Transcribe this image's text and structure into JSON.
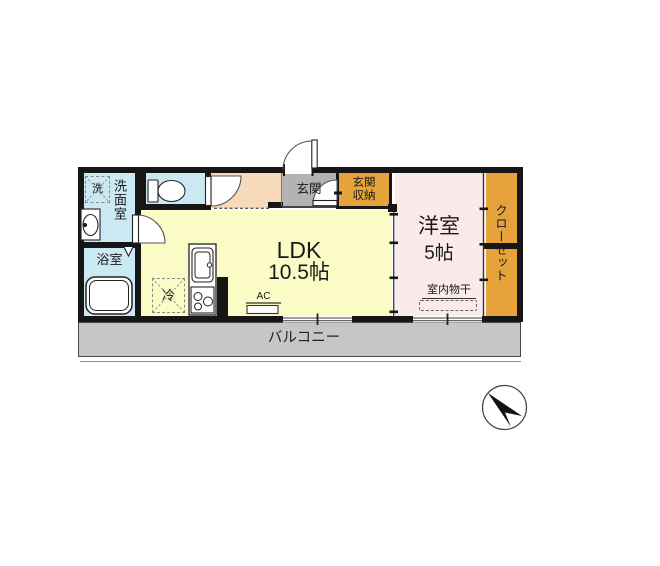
{
  "floorplan": {
    "rooms": {
      "washer": "洗",
      "washroom": "洗面室",
      "bathroom": "浴室",
      "refrigerator": "冷",
      "entrance": "玄関",
      "entrance_storage_line1": "玄関",
      "entrance_storage_line2": "収納",
      "ldk_name": "LDK",
      "ldk_size": "10.5帖",
      "western_name": "洋室",
      "western_size": "5帖",
      "closet": "クローゼット",
      "indoor_drying": "室内物干",
      "ac": "AC",
      "balcony": "バルコニー"
    },
    "colors": {
      "water_rooms": "#cbe9f2",
      "ldk": "#fafbc5",
      "hallway": "#f6dabb",
      "entrance": "#b3b3b3",
      "storage": "#e7a33b",
      "western_room": "#fbeaea",
      "balcony": "#c6c6c6",
      "wall": "#161616"
    }
  }
}
